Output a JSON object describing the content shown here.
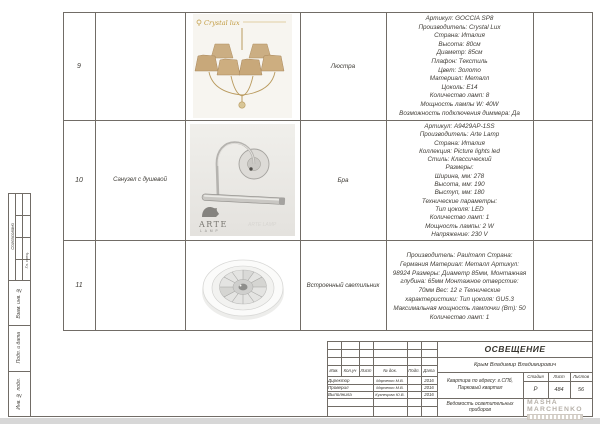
{
  "side_rail": {
    "approved": "Согласовано",
    "approved_cell": "Гл. спец.",
    "vzam": "Взам. инв. №",
    "podp_data": "Подп. и дата",
    "inv_podl": "Инв. № подл."
  },
  "fixtures_table": {
    "rows": [
      {
        "num": "9",
        "room": "",
        "photo_brand": "Crystal lux",
        "type": "Люстра",
        "specs": [
          "Артикул: GOCCIA SP8",
          "Производитель: Crystal Lux",
          "Страна: Италия",
          "Высота: 80см",
          "Диаметр: 85см",
          "Плафон: Текстиль",
          "Цвет: Золото",
          "Материал: Металл",
          "Цоколь: E14",
          "Количество ламп: 8",
          "Мощность лампы W: 40W",
          "Возможность подключения диммера: Да"
        ]
      },
      {
        "num": "10",
        "room": "Санузел с душевой",
        "photo_brand_line1": "ARTE",
        "photo_brand_line2": "LAMP",
        "photo_watermark": "ARTE LAMP",
        "type": "Бра",
        "specs": [
          "Артикул: A9429AP-1SS",
          "Производитель: Arte Lamp",
          "Страна: Италия",
          "Коллекция: Picture lights led",
          "Стиль: Классический",
          "Размеры:",
          "Ширина, мм: 278",
          "Высота, мм: 190",
          "Выступ, мм: 180",
          "Технические параметры:",
          "Тип цоколя: LED",
          "Количество ламп: 1",
          "Мощность лампы: 2 W",
          "Напряжение: 230 V"
        ]
      },
      {
        "num": "11",
        "room": "",
        "type": "Встроенный светильник",
        "specs": "Производитель: Paulmann Страна: Германия Материал: Металл Артикул: 98924 Размеры: Диаметр 85мм, Монтажная глубина: 65мм Монтажное отверстие: 70мм Вес: 12 г Технические характеристики: Тип цоколя: GU5.3 Максимальная мощность лампочки (Вт): 50 Количество ламп: 1"
      }
    ]
  },
  "title_block": {
    "doc_title": "ОСВЕЩЕНИЕ",
    "client": "Крым Владимир Владимирович",
    "project": "Квартира по адресу: г.СПб, Парковый квартал",
    "doc_name": "Ведомость осветительных приборов",
    "rev_header": {
      "izm": "Изм.",
      "kol": "Кол.уч",
      "list": "Лист",
      "doc": "№ док.",
      "podp": "Подп.",
      "data": "Дата"
    },
    "signatures": [
      {
        "role": "Директор",
        "name": "Марченко М.В.",
        "date": "2016"
      },
      {
        "role": "Проверил",
        "name": "Марченко М.В.",
        "date": "2016"
      },
      {
        "role": "Выполнила",
        "name": "Кузнецова Ю.В.",
        "date": "2016"
      }
    ],
    "stage_label": "Стадия",
    "sheet_label": "Лист",
    "sheets_label": "Листов",
    "stage": "Р",
    "sheet_num": "484",
    "sheets_total": "56",
    "logo_line1": "MASHA",
    "logo_line2": "MARCHENKO"
  }
}
